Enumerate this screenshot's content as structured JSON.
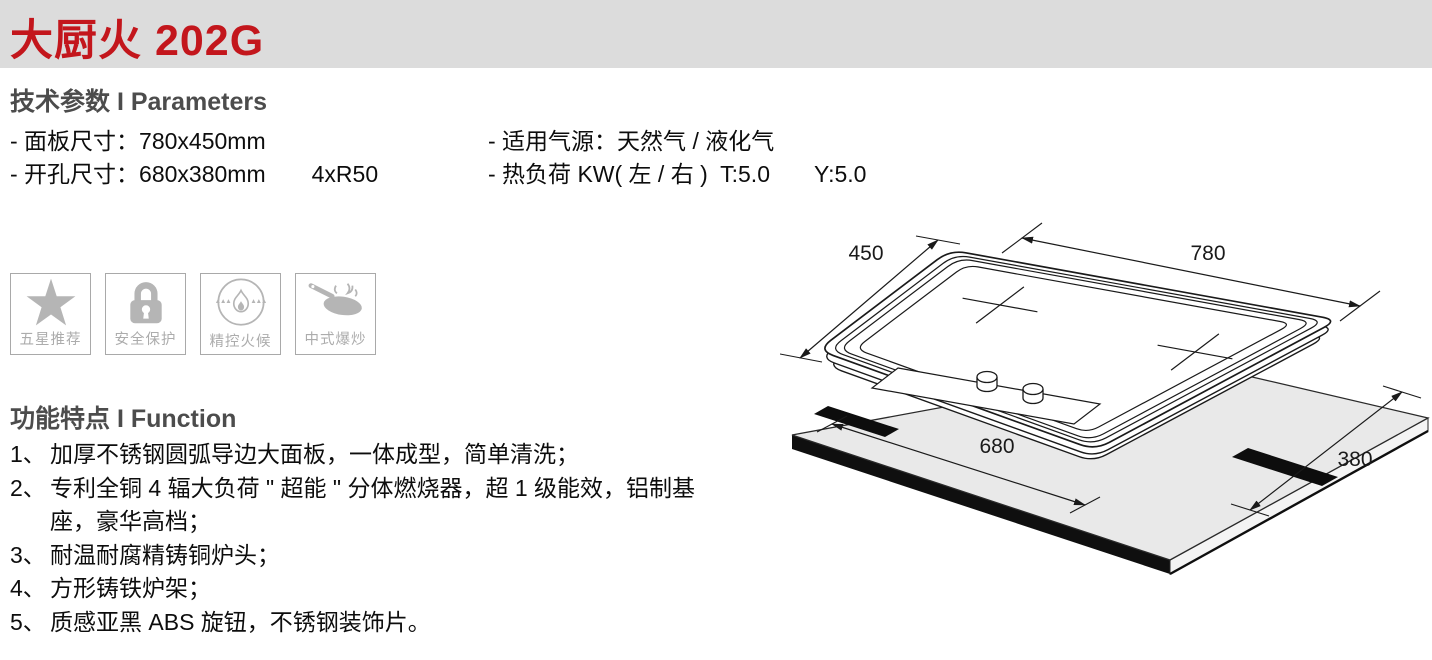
{
  "header": {
    "title": "大厨火 202G"
  },
  "parameters": {
    "heading": "技术参数 I Parameters",
    "panel_size": "- 面板尺寸：780x450mm",
    "cutout_size": "- 开孔尺寸：680x380mm",
    "corner_radius": "4xR50",
    "gas_source": "- 适用气源：天然气 / 液化气",
    "heat_load": "- 热负荷 KW( 左 / 右 )  T:5.0",
    "heat_load_right": "Y:5.0"
  },
  "badges": [
    {
      "label": "五星推荐"
    },
    {
      "label": "安全保护"
    },
    {
      "label": "精控火候"
    },
    {
      "label": "中式爆炒"
    }
  ],
  "features": {
    "heading": "功能特点 I Function",
    "items": [
      {
        "num": "1、",
        "text": "加厚不锈钢圆弧导边大面板，一体成型，简单清洗；"
      },
      {
        "num": "2、",
        "text": "专利全铜 4 辐大负荷 \" 超能 \" 分体燃烧器，超 1 级能效，铝制基座，豪华高档；"
      },
      {
        "num": "3、",
        "text": "耐温耐腐精铸铜炉头；"
      },
      {
        "num": "4、",
        "text": "方形铸铁炉架；"
      },
      {
        "num": "5、",
        "text": "质感亚黑 ABS 旋钮，不锈钢装饰片。"
      }
    ]
  },
  "diagram": {
    "dims": {
      "width": "780",
      "depth": "450",
      "cutout_width": "680",
      "cutout_depth": "380"
    }
  }
}
